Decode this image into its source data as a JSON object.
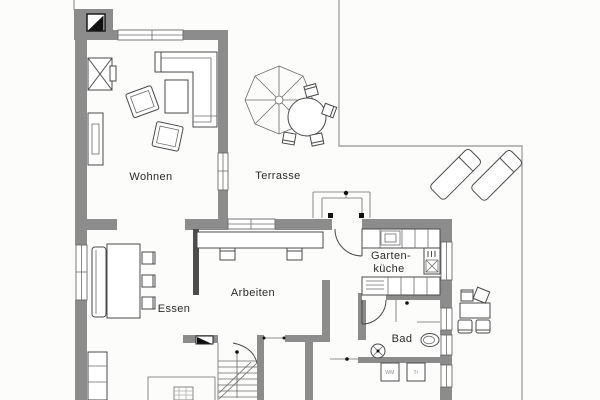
{
  "rooms": {
    "wohnen": {
      "label": "Wohnen"
    },
    "terrasse": {
      "label": "Terrasse"
    },
    "essen": {
      "label": "Essen"
    },
    "arbeiten": {
      "label": "Arbeiten"
    },
    "gartenkueche": {
      "label_line1": "Garten-",
      "label_line2": "küche"
    },
    "bad": {
      "label": "Bad"
    }
  },
  "appliances": {
    "washing_machine": "WM",
    "dryer": "Tr"
  },
  "colors": {
    "wall": "#8c8c8c",
    "interior_wall": "#4d4d4d",
    "line": "#4a4a4a",
    "thin_line": "#6b6b6b",
    "boundary": "#a3a3a3",
    "background": "#fcfcfb",
    "symbol": "#111111",
    "label": "#2b2b2b"
  }
}
